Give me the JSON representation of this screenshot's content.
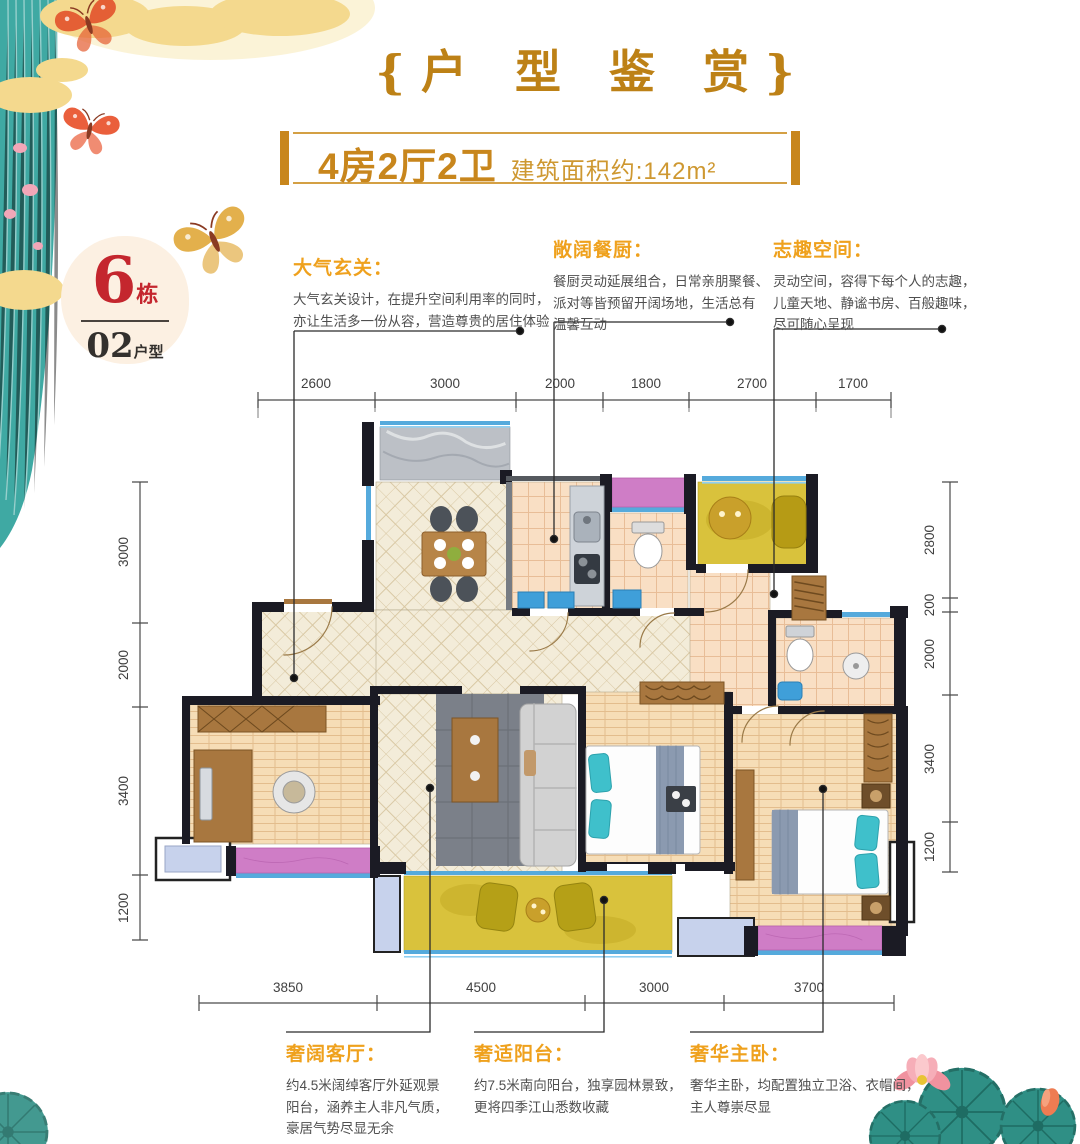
{
  "title": {
    "text": "{户 型 鉴 赏}"
  },
  "banner": {
    "layout": "4房2厅2卫",
    "area": "建筑面积约:142m²"
  },
  "badge": {
    "building_number": "6",
    "building_unit": "栋",
    "unit_number": "02",
    "unit_label": "户型"
  },
  "annotations": {
    "top": [
      {
        "title": "大气玄关：",
        "lines": [
          "大气玄关设计，在提升空间利用率的同时，",
          "亦让生活多一份从容，营造尊贵的居住体验"
        ]
      },
      {
        "title": "敞阔餐厨：",
        "lines": [
          "餐厨灵动延展组合，日常亲朋聚餐、",
          "派对等皆预留开阔场地，生活总有",
          "温馨互动"
        ]
      },
      {
        "title": "志趣空间：",
        "lines": [
          "灵动空间，容得下每个人的志趣，",
          "儿童天地、静谧书房、百般趣味，",
          "尽可随心呈现"
        ]
      }
    ],
    "bottom": [
      {
        "title": "奢阔客厅：",
        "lines": [
          "约4.5米阔绰客厅外延观景",
          "阳台，涵养主人非凡气质，",
          "豪居气势尽显无余"
        ]
      },
      {
        "title": "奢适阳台：",
        "lines": [
          "约7.5米南向阳台，独享园林景致，",
          "更将四季江山悉数收藏"
        ]
      },
      {
        "title": "奢华主卧：",
        "lines": [
          "奢华主卧，均配置独立卫浴、衣帽间，",
          "主人尊崇尽显"
        ]
      }
    ]
  },
  "dimensions": {
    "top": [
      "2600",
      "3000",
      "2000",
      "1800",
      "2700",
      "1700"
    ],
    "bottom": [
      "3850",
      "4500",
      "3000",
      "3700"
    ],
    "left": [
      "3000",
      "2000",
      "3400",
      "1200"
    ],
    "right": [
      "2800",
      "200",
      "2000",
      "3400",
      "1200"
    ]
  },
  "colors": {
    "gold": "#c8861c",
    "annotation_gold": "#efa11d",
    "red": "#c4262e",
    "body_text": "#4f4f4f",
    "wall": "#1b1b24",
    "cream_floor": "#f3ecd9",
    "tile_floor": "#f9dfc4",
    "wood_floor": "#f6ddb6",
    "yellow_room": "#d9c23c",
    "purple_accent": "#cf7dc6",
    "window_blue": "#55aadc",
    "marble": "#bcc0c6",
    "rug": "#7b8089",
    "furniture_wood": "#a8773f",
    "deco_teal": "#3fa9a3"
  },
  "decorations": {
    "top_left": "teal-curtain-gold-clouds-butterflies",
    "bottom_right": "lotus-flowers-and-leaves",
    "bottom_left": "lotus-leaf"
  }
}
